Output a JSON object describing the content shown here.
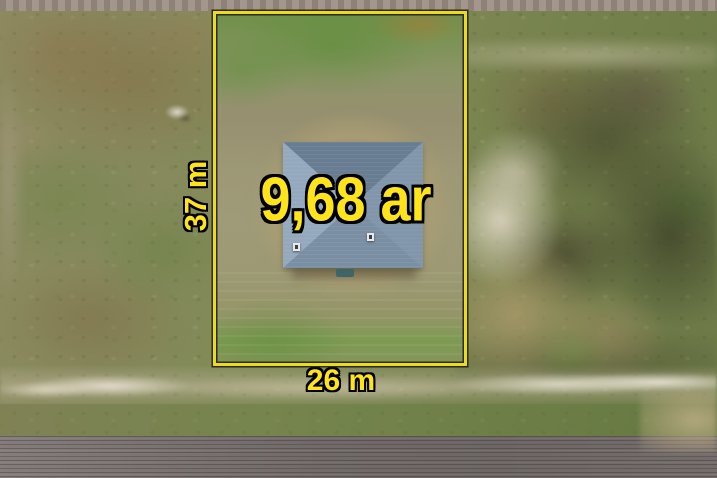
{
  "photo": {
    "labels": {
      "area": "9,68 ar",
      "frontage": "26 m",
      "depth": "37 m"
    },
    "colors": {
      "boundary_yellow": "#edda1d",
      "label_yellow": "#ffe41c",
      "label_outline": "#000000",
      "roof_top_face": "#687c92",
      "roof_left_face": "#95a9be",
      "roof_right_face": "#8196ab",
      "roof_bottom_face": "#7b8fa4"
    }
  }
}
